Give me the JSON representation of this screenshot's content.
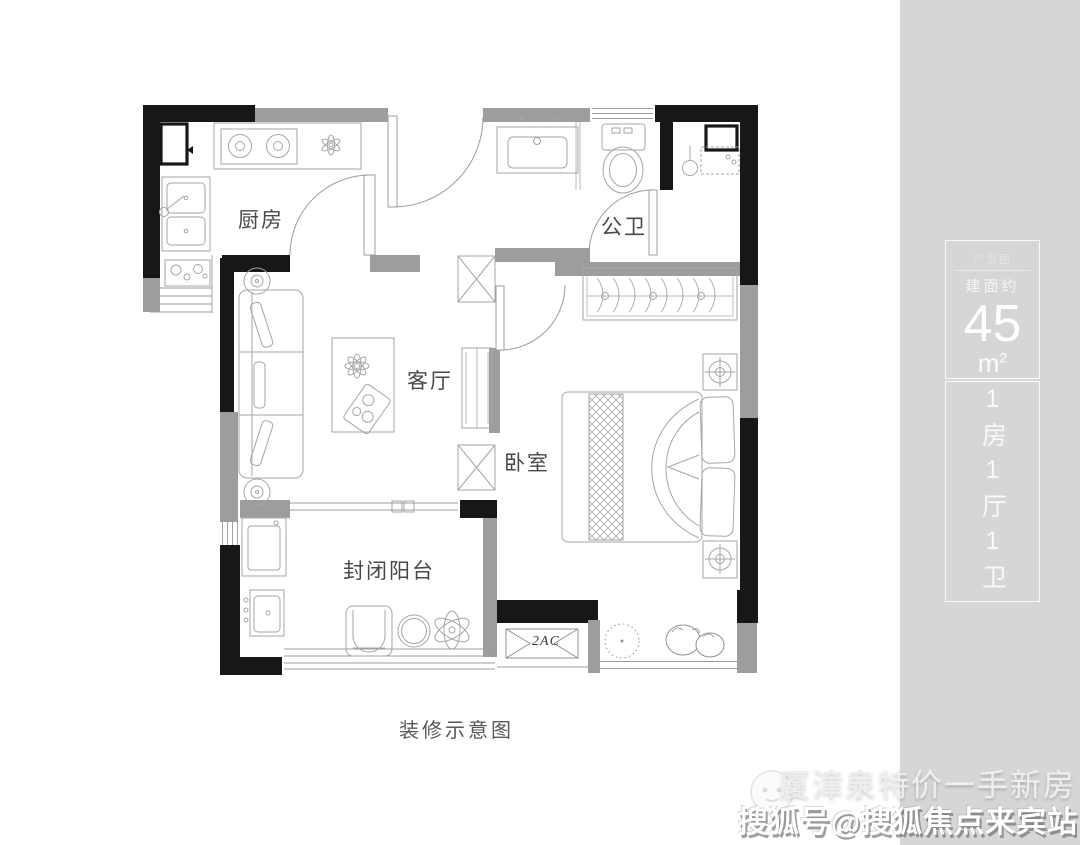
{
  "colors": {
    "panel_bg": "#d6d6d8",
    "wall_black": "#171717",
    "wall_gray": "#9d9da0",
    "line_gray": "#a5a6a8",
    "label_gray": "#48484a"
  },
  "floor_plan": {
    "caption": "装修示意图",
    "rooms": {
      "kitchen": "厨房",
      "bathroom": "公卫",
      "living": "客厅",
      "bedroom": "卧室",
      "balcony": "封闭阳台"
    },
    "ac_unit_label": "2AC"
  },
  "info_panel": {
    "tag": "户型图",
    "area_prefix": "建面约",
    "area_value": "45",
    "area_unit": "m",
    "area_unit_exp": "2",
    "layout": "1房1厅1卫"
  },
  "watermark": {
    "line1": "厦漳泉特价一手新房",
    "line2": "搜狐号@搜狐焦点来宾站"
  }
}
